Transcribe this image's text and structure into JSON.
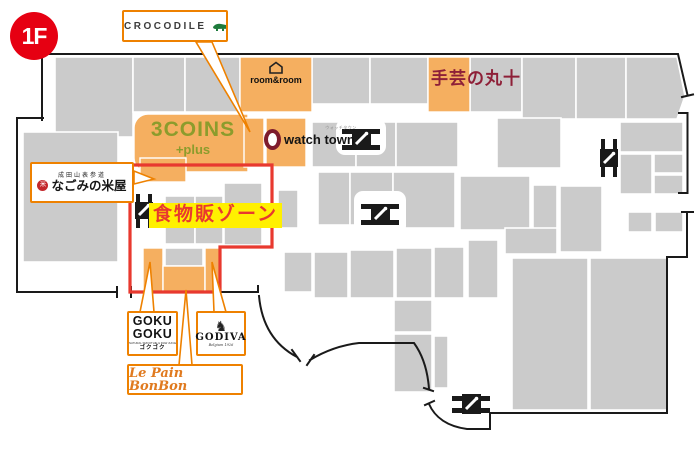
{
  "floor": {
    "badge": "1F"
  },
  "zone": {
    "label": "食物販ゾーン"
  },
  "map_labels": {
    "three_coins": {
      "title": "3COINS",
      "subtitle": "+plus"
    },
    "watch_town": {
      "title": "watch town",
      "kana": "ウォッチタウン"
    },
    "room_and_room": {
      "title": "room&room"
    },
    "shugei_marujyu": {
      "title": "手芸の丸十"
    }
  },
  "callouts": {
    "crocodile": {
      "title": "CROCODILE"
    },
    "nagomi_yoneya": {
      "top": "成田山表参道",
      "title": "なごみの米屋",
      "seal": "米"
    },
    "goku_goku": {
      "line1": "GOKU",
      "line2": "GOKU",
      "tagline": "NATURAL SMOOTHIE & RAW JUICE",
      "kana": "ゴクゴク"
    },
    "godiva": {
      "title": "GODIVA",
      "subtitle": "Belgium 1926",
      "emblem": "♞"
    },
    "le_pain_bonbon": {
      "title": "Le Pain BonBon"
    }
  },
  "colors": {
    "highlight_orange": "#F5AF60",
    "callout_orange": "#EE8100",
    "zone_red": "#E8392F",
    "badge_red": "#E60012",
    "zone_yellow": "#FFF000",
    "store_gray": "#CBCBCB",
    "coins_olive": "#8C9C2C",
    "marujyu_red": "#8E2038",
    "watch_maroon": "#7D1B2D",
    "crocodile_green": "#1E7B3C"
  }
}
